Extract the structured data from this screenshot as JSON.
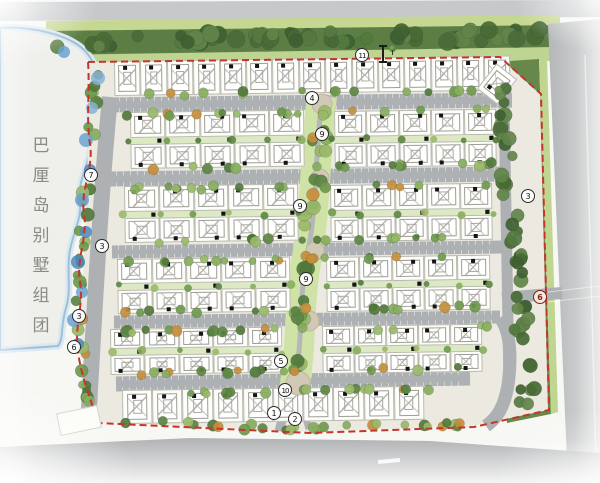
{
  "site_label": {
    "text": "巴厘岛别墅组团",
    "chars": [
      "巴",
      "厘",
      "岛",
      "别",
      "墅",
      "组",
      "团"
    ]
  },
  "legend_markers": [
    {
      "num": "11",
      "x": 362,
      "y": 55
    },
    {
      "num": "4",
      "x": 312,
      "y": 98
    },
    {
      "num": "9",
      "x": 322,
      "y": 134
    },
    {
      "num": "7",
      "x": 91,
      "y": 175
    },
    {
      "num": "3",
      "x": 528,
      "y": 196
    },
    {
      "num": "9",
      "x": 300,
      "y": 206
    },
    {
      "num": "3",
      "x": 102,
      "y": 246
    },
    {
      "num": "9",
      "x": 306,
      "y": 279
    },
    {
      "num": "3",
      "x": 79,
      "y": 316
    },
    {
      "num": "6",
      "x": 74,
      "y": 347
    },
    {
      "num": "5",
      "x": 281,
      "y": 361
    },
    {
      "num": "10",
      "x": 285,
      "y": 390
    },
    {
      "num": "1",
      "x": 274,
      "y": 413
    },
    {
      "num": "2",
      "x": 295,
      "y": 419
    },
    {
      "num": "6",
      "x": 540,
      "y": 297,
      "variant": "entrance"
    }
  ],
  "map": {
    "colors": {
      "boundary_red": "#c5352a",
      "road_gray": "#aeb1b3",
      "outer_road": "#c6c8ca",
      "ground": "#ece9e0",
      "plot_white": "#fdfdfa",
      "green_light": "#c6d791",
      "green_belt": "#5c7e45",
      "spine_green": "#cfe3a7",
      "water_blue": "#5d93c2",
      "tree_bright": "#6f9a4e",
      "tree_orange": "#c68e3c",
      "plaza_tan": "#d2c8b6"
    },
    "clusters": [
      {
        "id": "north-villa-row",
        "x": 114,
        "y": 61,
        "w": 396,
        "h": 35,
        "rows": 1,
        "units": 15
      },
      {
        "id": "block-a-west",
        "x": 130,
        "y": 112,
        "w": 174,
        "h": 57,
        "rows": 2,
        "units": 5
      },
      {
        "id": "block-a-east",
        "x": 334,
        "y": 111,
        "w": 162,
        "h": 57,
        "rows": 2,
        "units": 5
      },
      {
        "id": "block-b-west",
        "x": 124,
        "y": 186,
        "w": 174,
        "h": 57,
        "rows": 2,
        "units": 5
      },
      {
        "id": "block-b-east",
        "x": 330,
        "y": 185,
        "w": 162,
        "h": 57,
        "rows": 2,
        "units": 5
      },
      {
        "id": "block-c-west",
        "x": 117,
        "y": 259,
        "w": 173,
        "h": 55,
        "rows": 2,
        "units": 5
      },
      {
        "id": "block-c-east",
        "x": 326,
        "y": 257,
        "w": 164,
        "h": 55,
        "rows": 2,
        "units": 5
      },
      {
        "id": "block-d-west",
        "x": 110,
        "y": 329,
        "w": 172,
        "h": 46,
        "rows": 2,
        "units": 5
      },
      {
        "id": "block-d-east",
        "x": 322,
        "y": 326,
        "w": 160,
        "h": 48,
        "rows": 2,
        "units": 5
      },
      {
        "id": "south-villa-row",
        "x": 122,
        "y": 390,
        "w": 302,
        "h": 34,
        "rows": 1,
        "units": 10
      }
    ],
    "corner_unit": {
      "x": 484,
      "y": 68,
      "w": 26,
      "h": 32,
      "rotate": 38
    }
  }
}
